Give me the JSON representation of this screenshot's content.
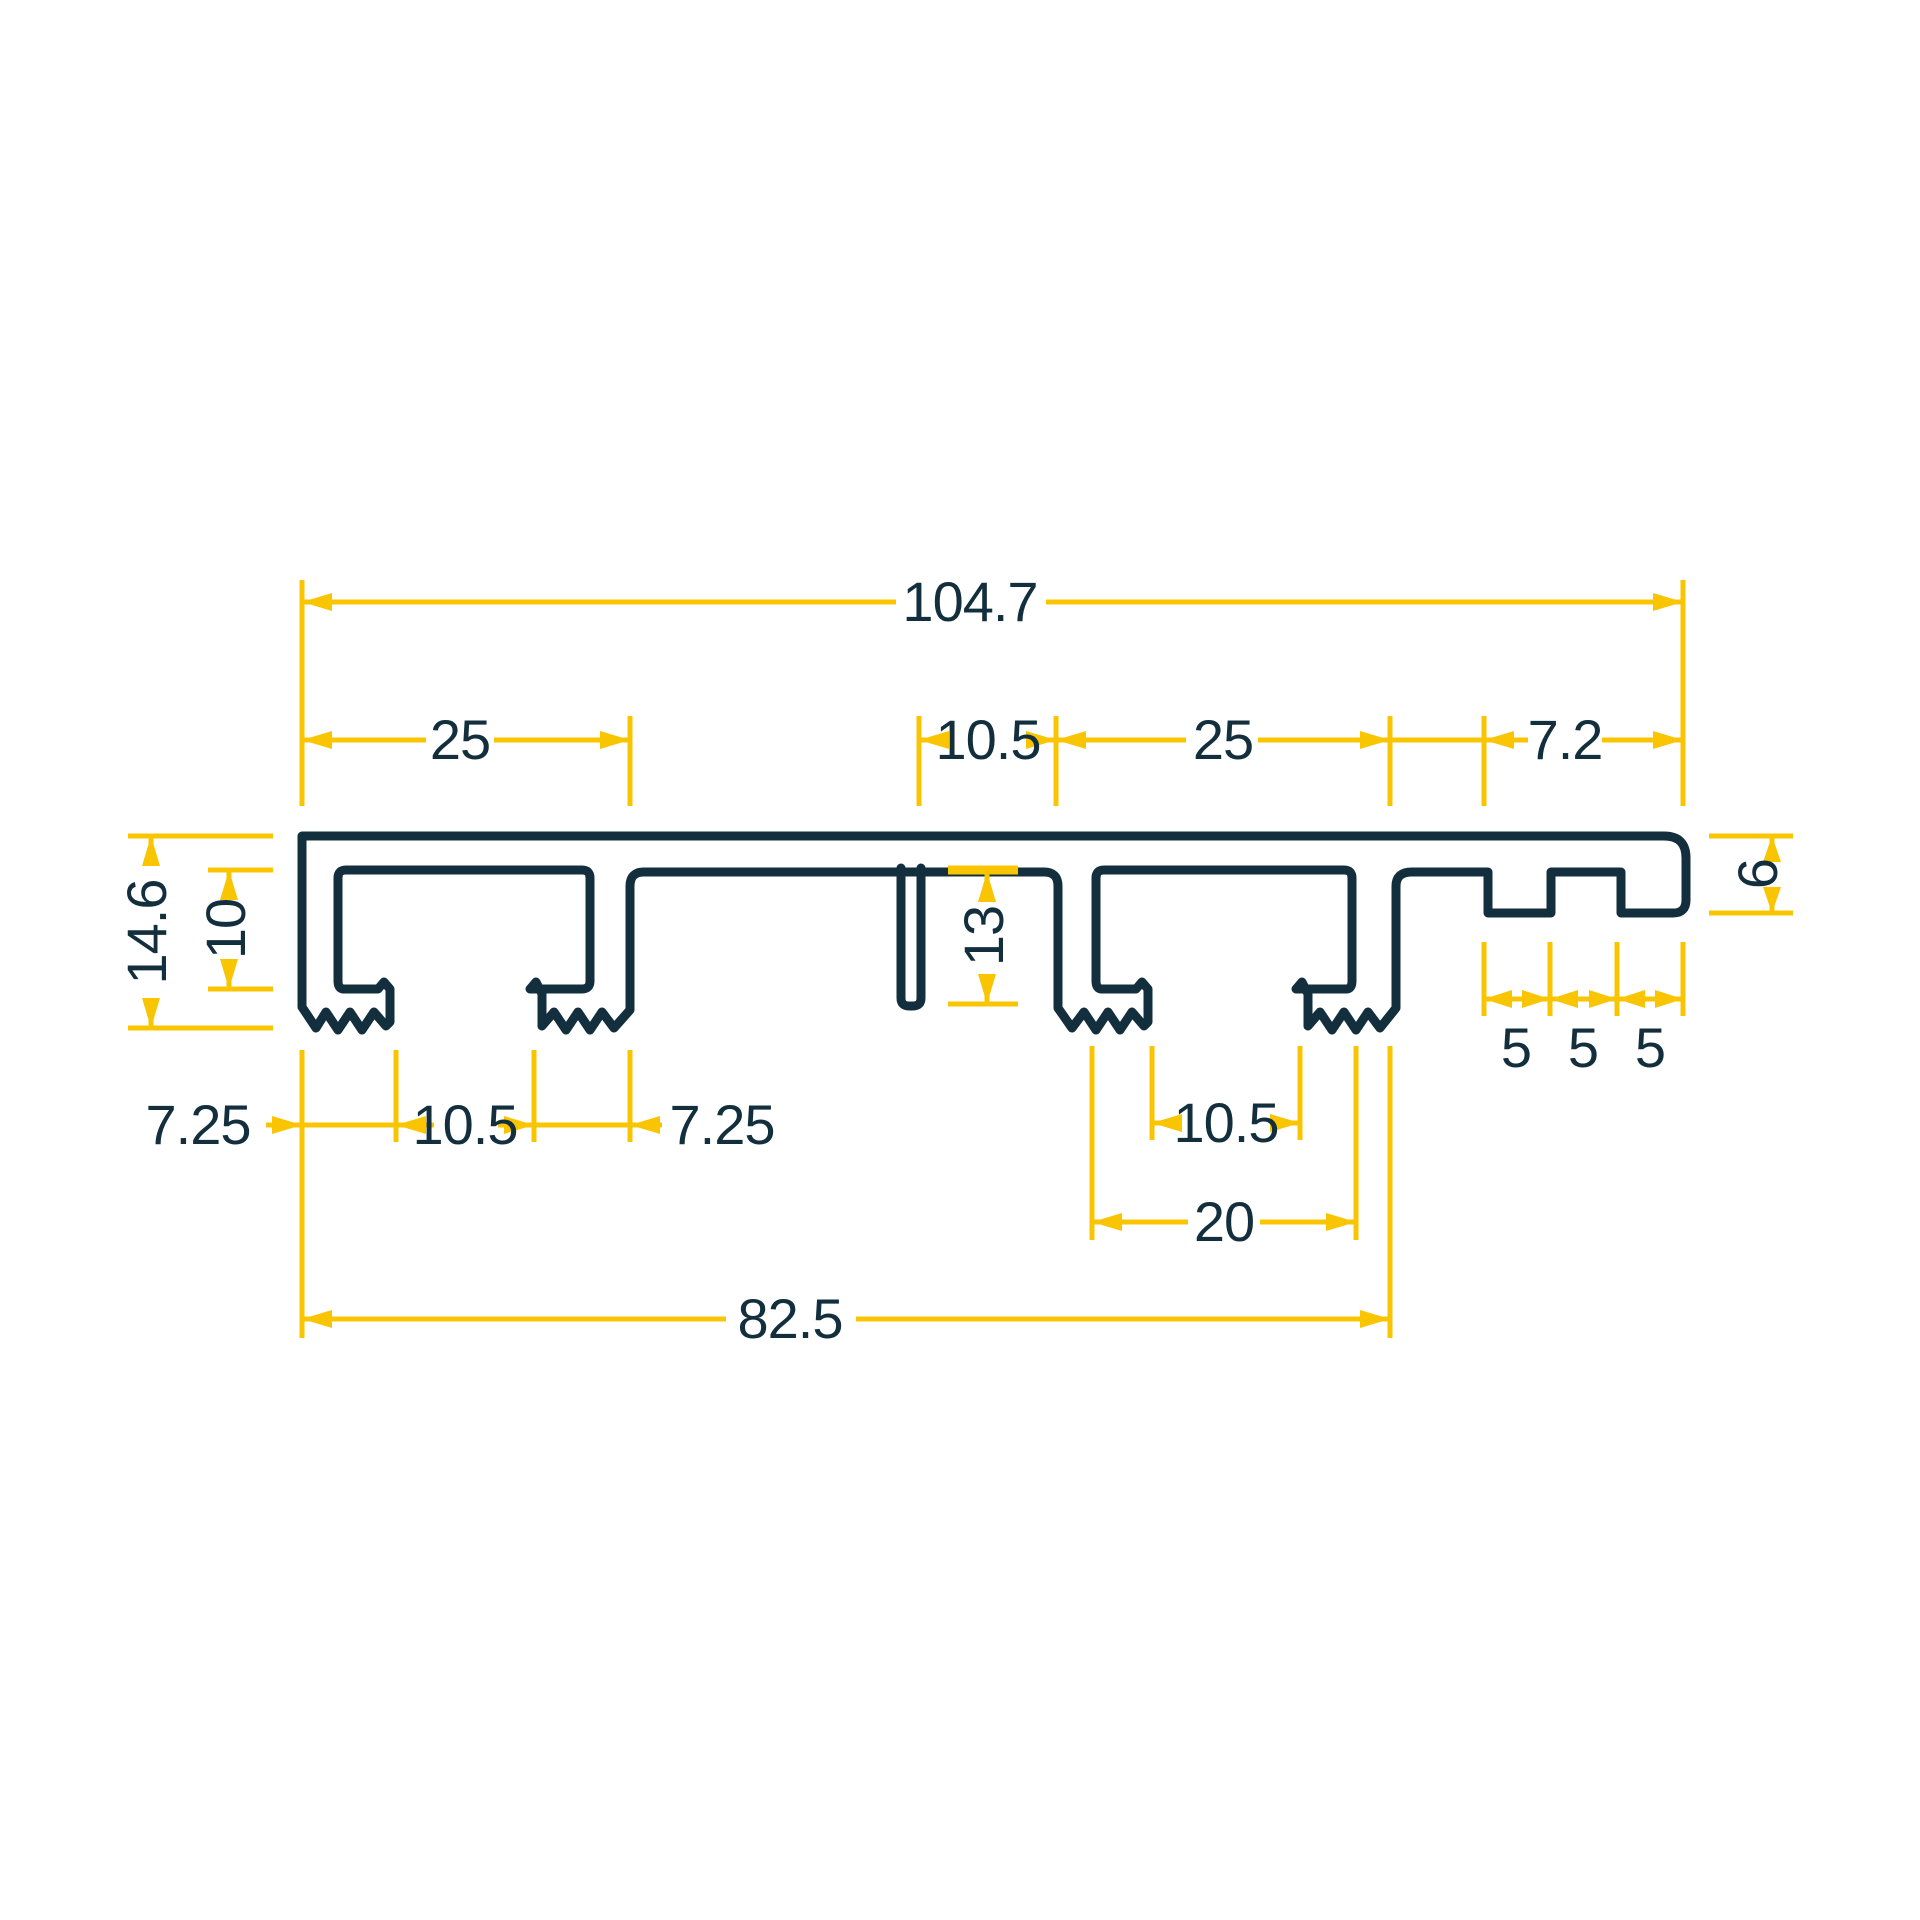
{
  "drawing": {
    "kind": "profile-cross-section",
    "units_implied": "mm",
    "colors": {
      "outline": "#132F3D",
      "dimension_lines": "#F8C500",
      "background": "#FFFFFF"
    },
    "dims": {
      "overall_width": "104.7",
      "left_channel_width": "25",
      "center_web_width": "10.5",
      "right_channel_width": "25",
      "right_end_width": "7.2",
      "overall_height": "14.6",
      "channel_depth": "10",
      "slot_depth": "13",
      "right_end_thickness": "6",
      "right_steps": [
        "5",
        "5",
        "5"
      ],
      "left_foot_left": "7.25",
      "left_opening": "10.5",
      "left_foot_right": "7.25",
      "right_opening": "10.5",
      "right_channel_inner_width": "20",
      "base_width": "82.5"
    }
  }
}
